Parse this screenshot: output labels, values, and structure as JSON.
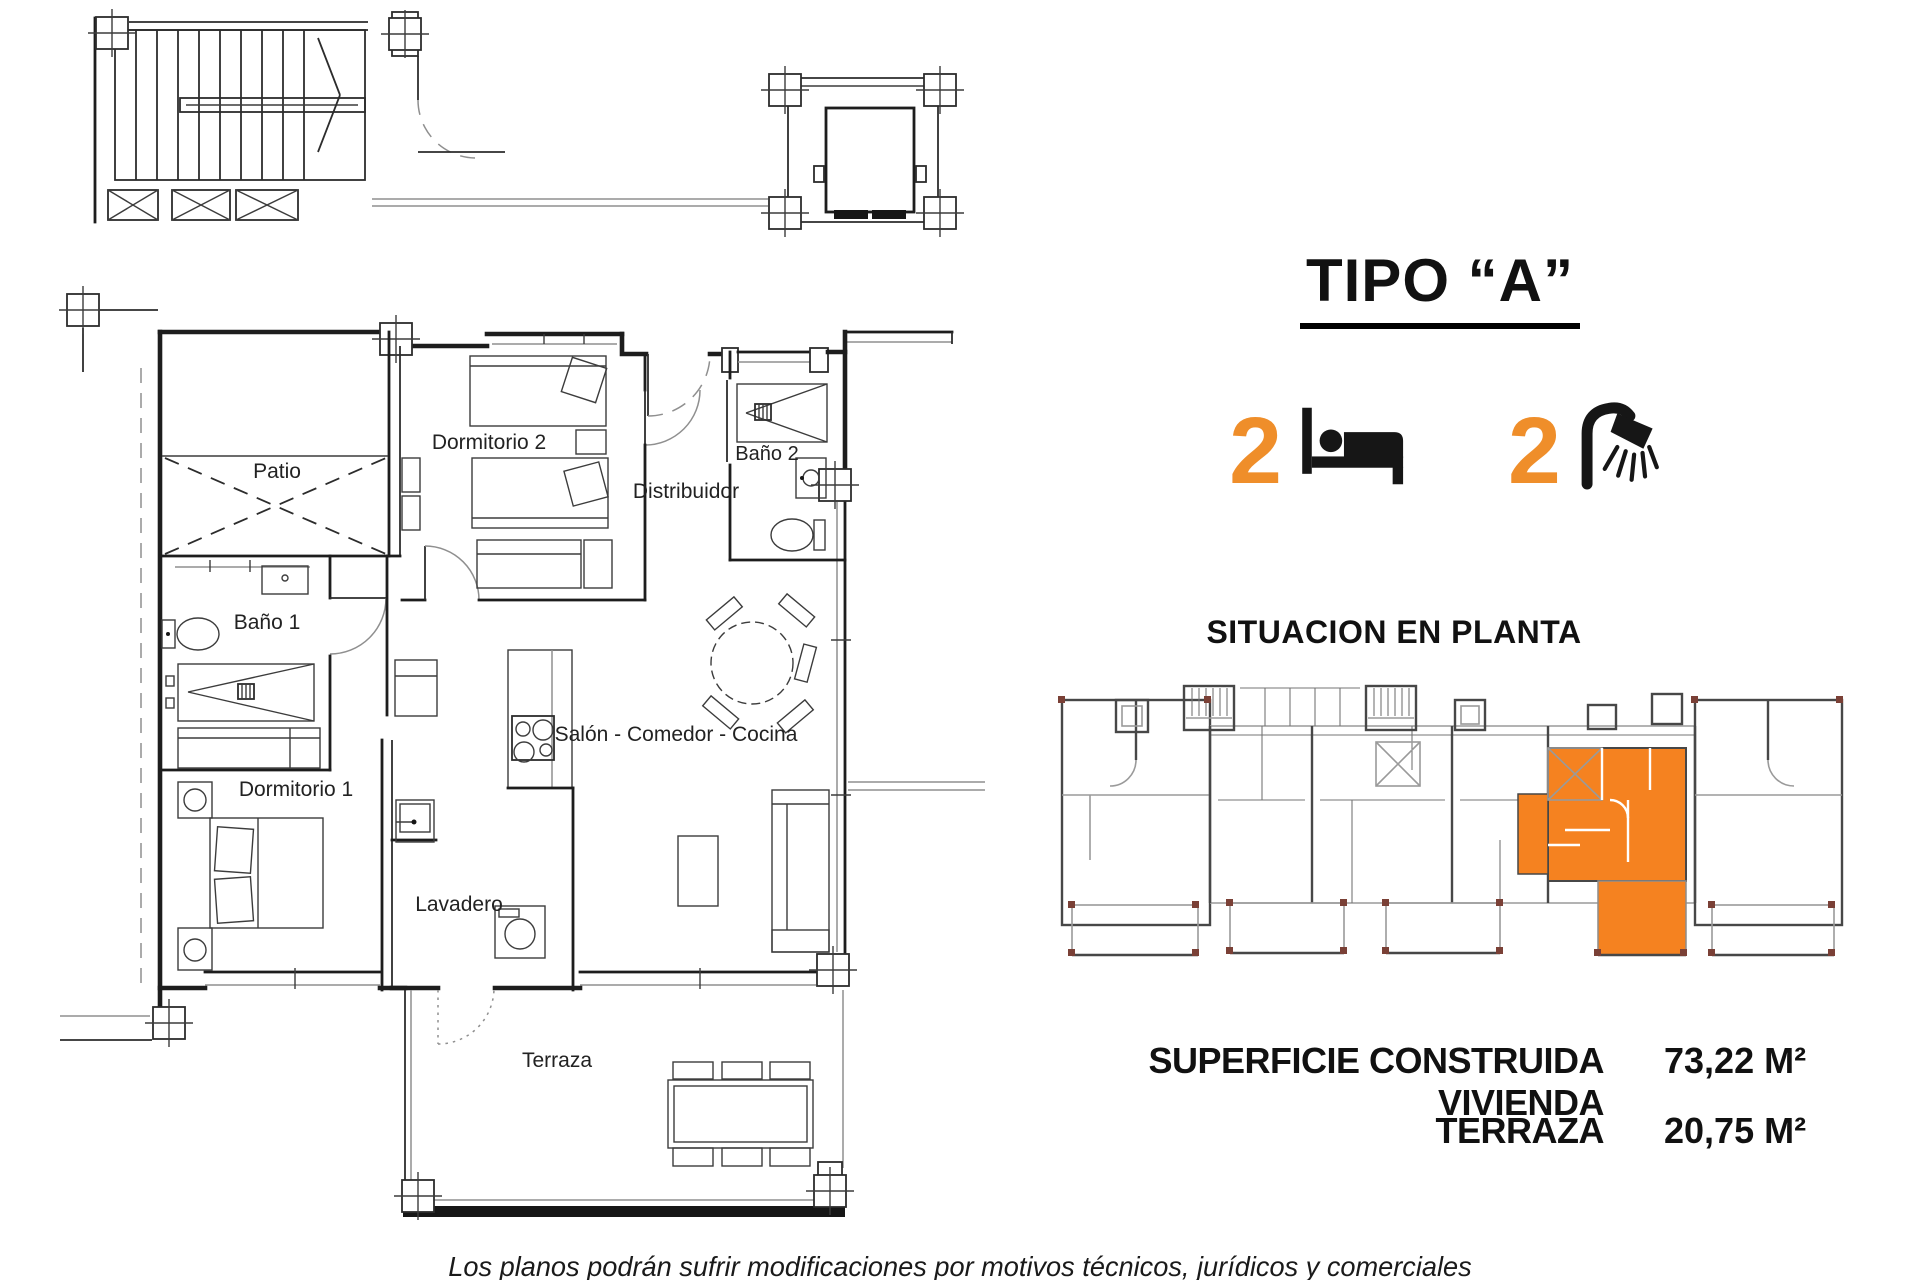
{
  "document": {
    "background": "#ffffff"
  },
  "floor_plan": {
    "rooms": [
      {
        "label": "Patio"
      },
      {
        "label": "Dormitorio 2"
      },
      {
        "label": "Distribuidor"
      },
      {
        "label": "Baño 2"
      },
      {
        "label": "Baño 1"
      },
      {
        "label": "Salón - Comedor - Cocina"
      },
      {
        "label": "Dormitorio 1"
      },
      {
        "label": "Lavadero"
      },
      {
        "label": "Terraza"
      }
    ]
  },
  "info_panel": {
    "type_title": "TIPO “A”",
    "features": [
      {
        "icon": "bed-icon",
        "count": "2"
      },
      {
        "icon": "shower-icon",
        "count": "2"
      }
    ],
    "situation_title": "SITUACION EN PLANTA",
    "areas": [
      {
        "label": "SUPERFICIE CONSTRUIDA VIVIENDA",
        "value": "73,22 M²"
      },
      {
        "label": "TERRAZA",
        "value": "20,75 M²"
      }
    ]
  },
  "footer": {
    "disclaimer": "Los planos podrán sufrir modificaciones por motivos técnicos, jurídicos y comerciales"
  },
  "colors": {
    "accent_orange": "#EF8E2A",
    "highlight_orange": "#F58220",
    "plan_line": "#1d1d1d",
    "plan_gray": "#8f8f8f"
  }
}
